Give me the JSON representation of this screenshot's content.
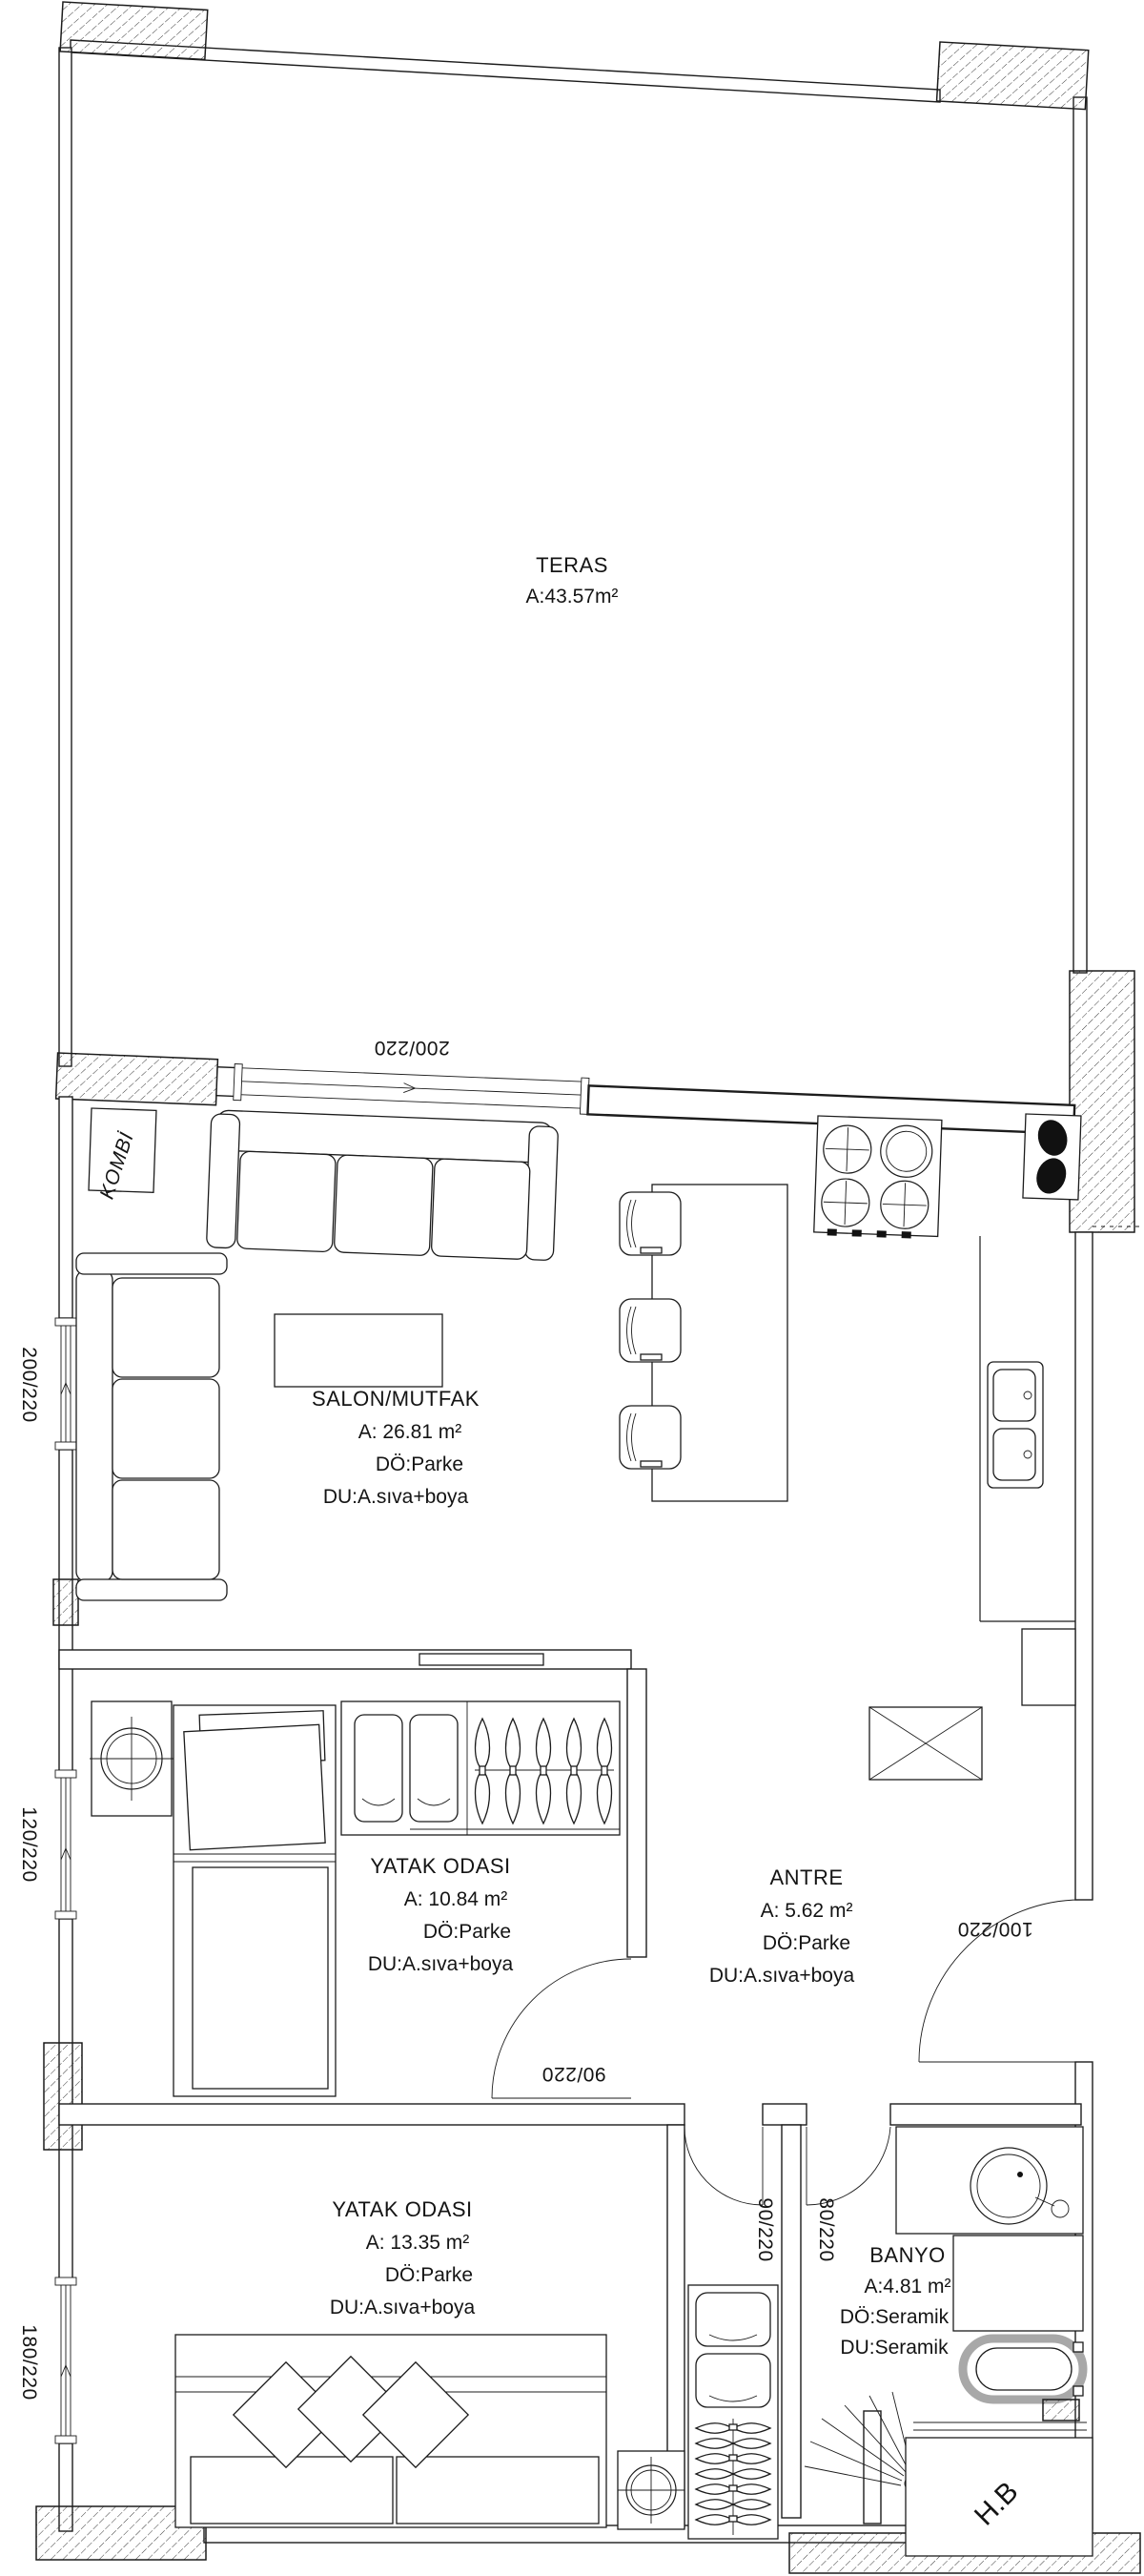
{
  "plan": {
    "terrace": {
      "name": "TERAS",
      "area": "A:43.57m²"
    },
    "rooms": [
      {
        "id": "salon",
        "name": "SALON/MUTFAK",
        "area": "A: 26.81 m²",
        "floor": "DÖ:Parke",
        "wall": "DU:A.sıva+boya"
      },
      {
        "id": "bedroom1",
        "name": "YATAK ODASI",
        "area": "A: 10.84 m²",
        "floor": "DÖ:Parke",
        "wall": "DU:A.sıva+boya"
      },
      {
        "id": "antre",
        "name": "ANTRE",
        "area": "A: 5.62 m²",
        "floor": "DÖ:Parke",
        "wall": "DU:A.sıva+boya"
      },
      {
        "id": "bedroom2",
        "name": "YATAK ODASI",
        "area": "A: 13.35 m²",
        "floor": "DÖ:Parke",
        "wall": "DU:A.sıva+boya"
      },
      {
        "id": "banyo",
        "name": "BANYO",
        "area": "A:4.81 m²",
        "floor": "DÖ:Seramik",
        "wall": "DU:Seramik"
      }
    ],
    "labels": {
      "boiler": "KOMBİ",
      "shaft": "H.B"
    },
    "dimensions": {
      "terrace_window": "200/220",
      "salon_window": "200/220",
      "bedroom1_window": "120/220",
      "bedroom2_window": "180/220",
      "entry_door": "100/220",
      "bedroom1_door": "90/220",
      "bedroom2_door": "90/220",
      "bathroom_door": "80/220"
    },
    "colors": {
      "line": "#1c1c1c",
      "paper": "#ffffff",
      "fixture_gray": "#a8a8a8"
    }
  }
}
